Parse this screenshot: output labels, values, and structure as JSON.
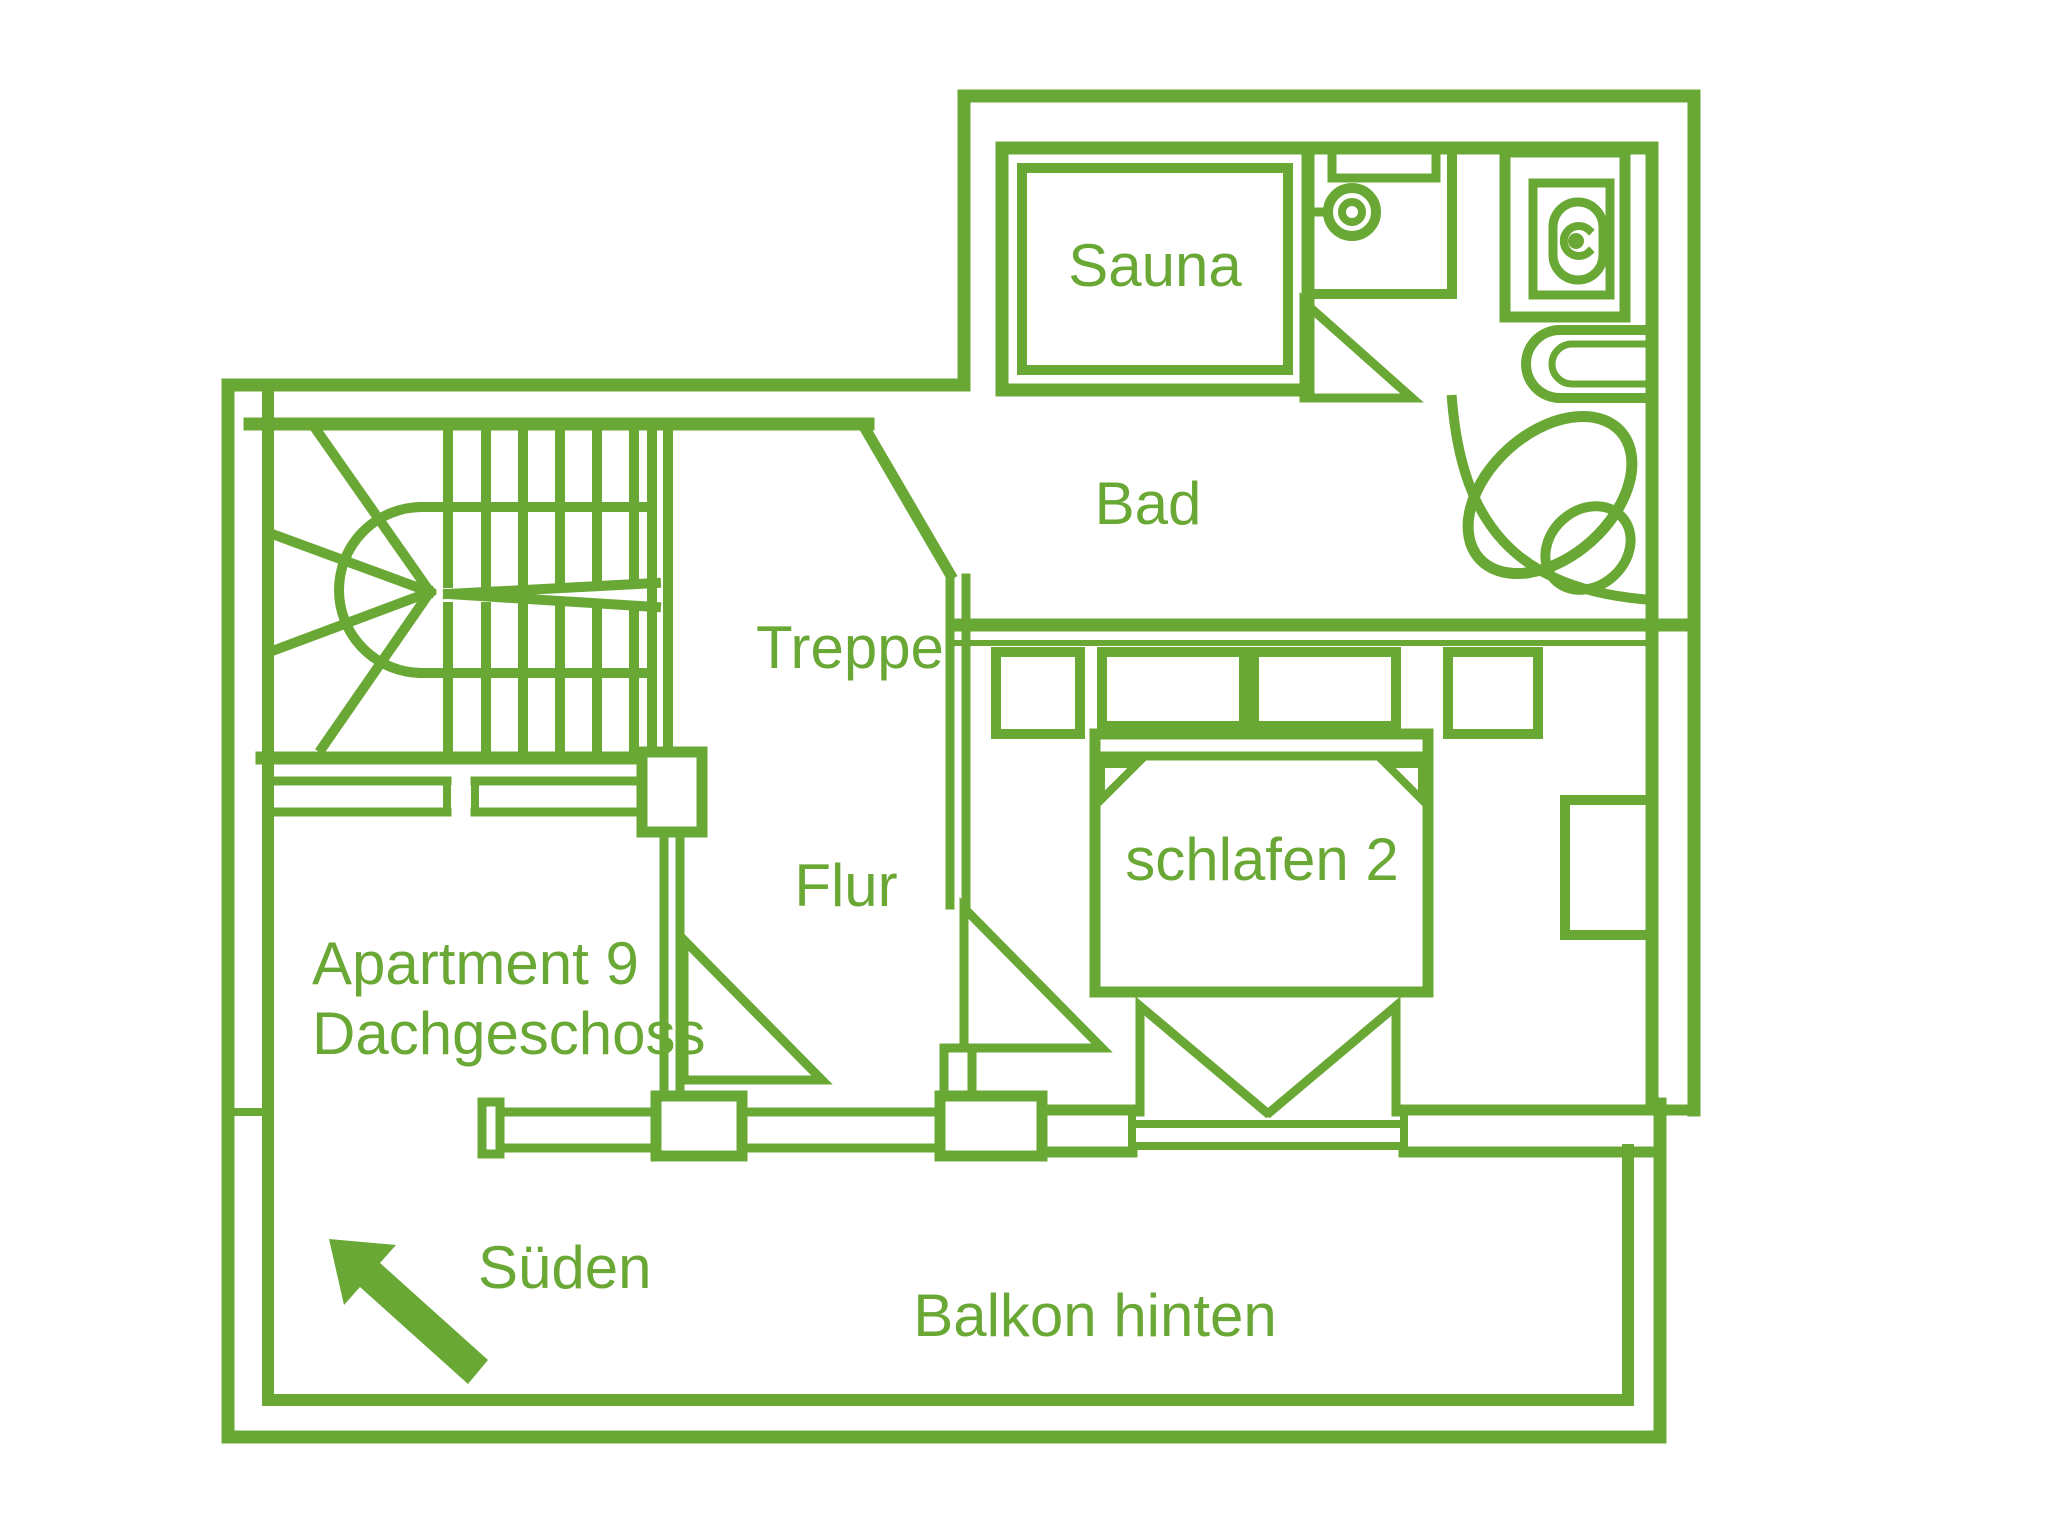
{
  "title": "Apartment 9 Dachgeschoss floor plan",
  "colors": {
    "line_green": "#6aa835",
    "background": "#ffffff"
  },
  "labels": {
    "sauna": "Sauna",
    "bad": "Bad",
    "treppe": "Treppe",
    "flur": "Flur",
    "apartment_line1": "Apartment 9",
    "apartment_line2": "Dachgeschoss",
    "schlafen": "schlafen 2",
    "sueden": "Süden",
    "balkon": "Balkon hinten"
  },
  "rooms": [
    {
      "name": "Sauna"
    },
    {
      "name": "Bad"
    },
    {
      "name": "Treppe"
    },
    {
      "name": "Flur"
    },
    {
      "name": "Apartment 9 Dachgeschoss"
    },
    {
      "name": "schlafen 2"
    },
    {
      "name": "Balkon hinten"
    }
  ],
  "fixtures": [
    {
      "icon": "stairs-icon",
      "room": "Treppe"
    },
    {
      "icon": "sauna-cabin-icon",
      "room": "Bad"
    },
    {
      "icon": "shower-head-icon",
      "room": "Bad"
    },
    {
      "icon": "toilet-icon",
      "room": "Bad"
    },
    {
      "icon": "washbasin-icon",
      "room": "Bad"
    },
    {
      "icon": "corner-bathtub-icon",
      "room": "Bad"
    },
    {
      "icon": "double-bed-icon",
      "room": "schlafen 2"
    },
    {
      "icon": "wardrobe-icon",
      "room": "schlafen 2"
    },
    {
      "icon": "south-arrow-icon",
      "room": "Balkon hinten"
    }
  ],
  "compass": {
    "direction_label": "Süden",
    "arrow_points": "south-west"
  }
}
